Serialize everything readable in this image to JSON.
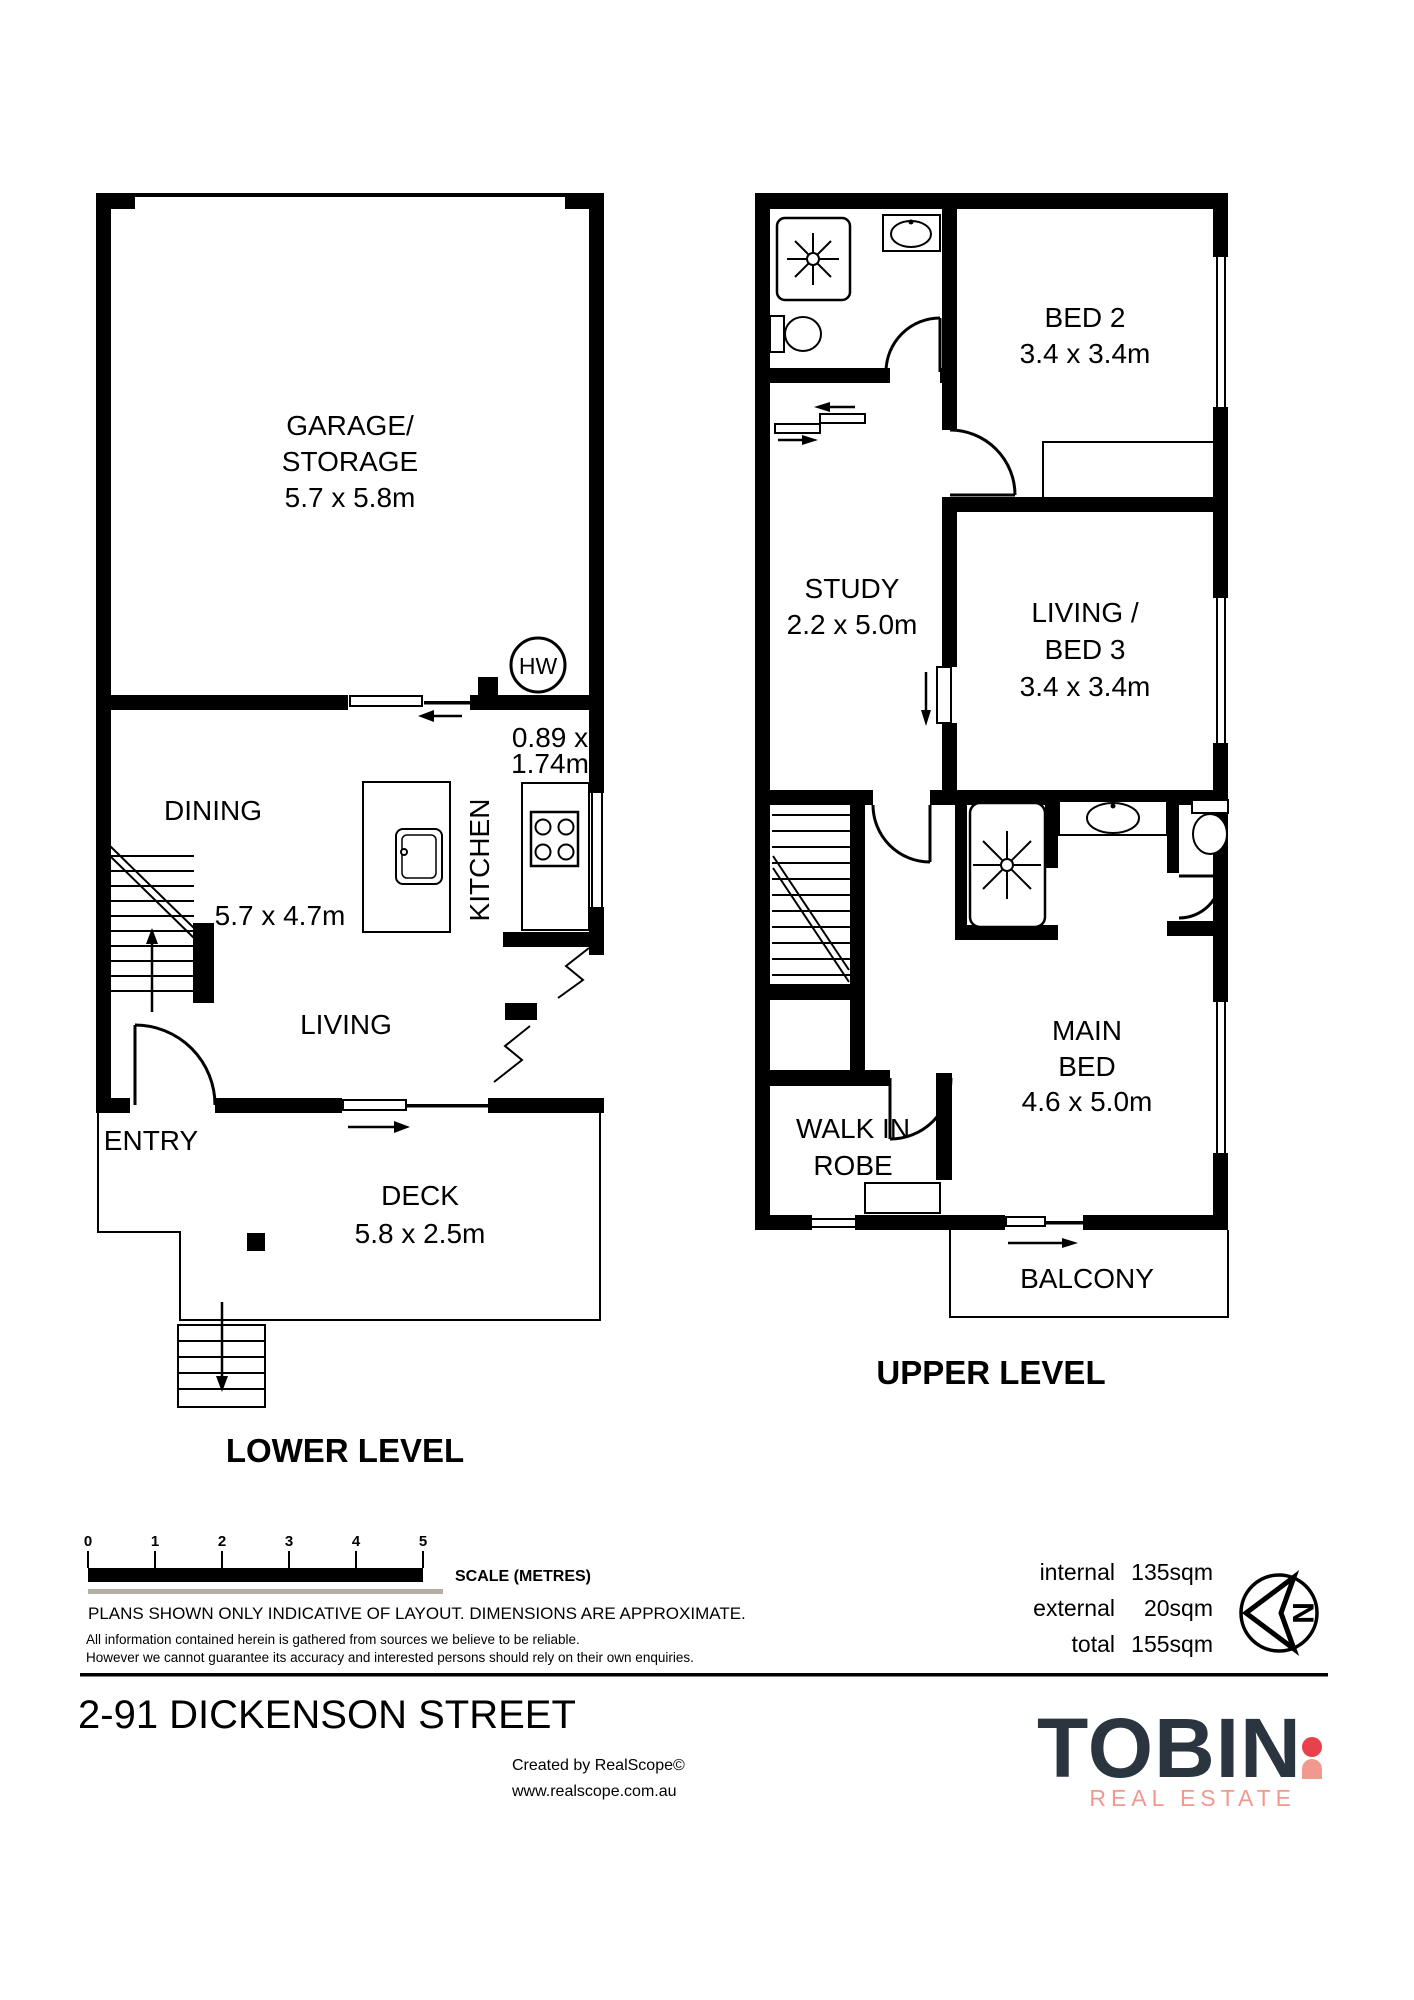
{
  "colors": {
    "line": "#000000",
    "scale_gray": "#b3aea3",
    "logo_navy": "#2b3540",
    "logo_red": "#e8414d",
    "logo_coral": "#f2998f"
  },
  "lower_level": {
    "title": "LOWER LEVEL",
    "garage": {
      "line1": "GARAGE/",
      "line2": "STORAGE",
      "dims": "5.7 x 5.8m"
    },
    "dining": {
      "label": "DINING",
      "dims": "5.7 x 4.7m"
    },
    "kitchen": {
      "label": "KITCHEN",
      "pantry_dims_line1": "0.89 x",
      "pantry_dims_line2": "1.74m"
    },
    "living": {
      "label": "LIVING"
    },
    "entry": {
      "label": "ENTRY"
    },
    "deck": {
      "label": "DECK",
      "dims": "5.8 x 2.5m"
    },
    "hot_water": {
      "label": "HW"
    }
  },
  "upper_level": {
    "title": "UPPER LEVEL",
    "bed2": {
      "label": "BED 2",
      "dims": "3.4 x 3.4m"
    },
    "study": {
      "label": "STUDY",
      "dims": "2.2 x 5.0m"
    },
    "living_bed3": {
      "line1": "LIVING /",
      "line2": "BED 3",
      "dims": "3.4 x 3.4m"
    },
    "main_bed": {
      "line1": "MAIN",
      "line2": "BED",
      "dims": "4.6 x 5.0m"
    },
    "walk_in_robe": {
      "line1": "WALK IN",
      "line2": "ROBE"
    },
    "balcony": {
      "label": "BALCONY"
    }
  },
  "footer": {
    "scale": {
      "ticks": [
        "0",
        "1",
        "2",
        "3",
        "4",
        "5"
      ],
      "label": "SCALE (METRES)"
    },
    "note": "PLANS SHOWN ONLY INDICATIVE OF LAYOUT.  DIMENSIONS ARE APPROXIMATE.",
    "disclaimer_line1": "All information contained herein is gathered from sources we believe to be reliable.",
    "disclaimer_line2": "However we cannot guarantee its accuracy and interested persons should rely on their own enquiries.",
    "address": "2-91 DICKENSON STREET",
    "areas": [
      {
        "label": "internal",
        "value": "135sqm"
      },
      {
        "label": "external",
        "value": "20sqm"
      },
      {
        "label": "total",
        "value": "155sqm"
      }
    ],
    "north": {
      "label": "N"
    },
    "credit_line1": "Created by RealScope©",
    "credit_line2": "www.realscope.com.au",
    "logo": {
      "name": "TOBIN",
      "tagline": "REAL ESTATE"
    }
  }
}
